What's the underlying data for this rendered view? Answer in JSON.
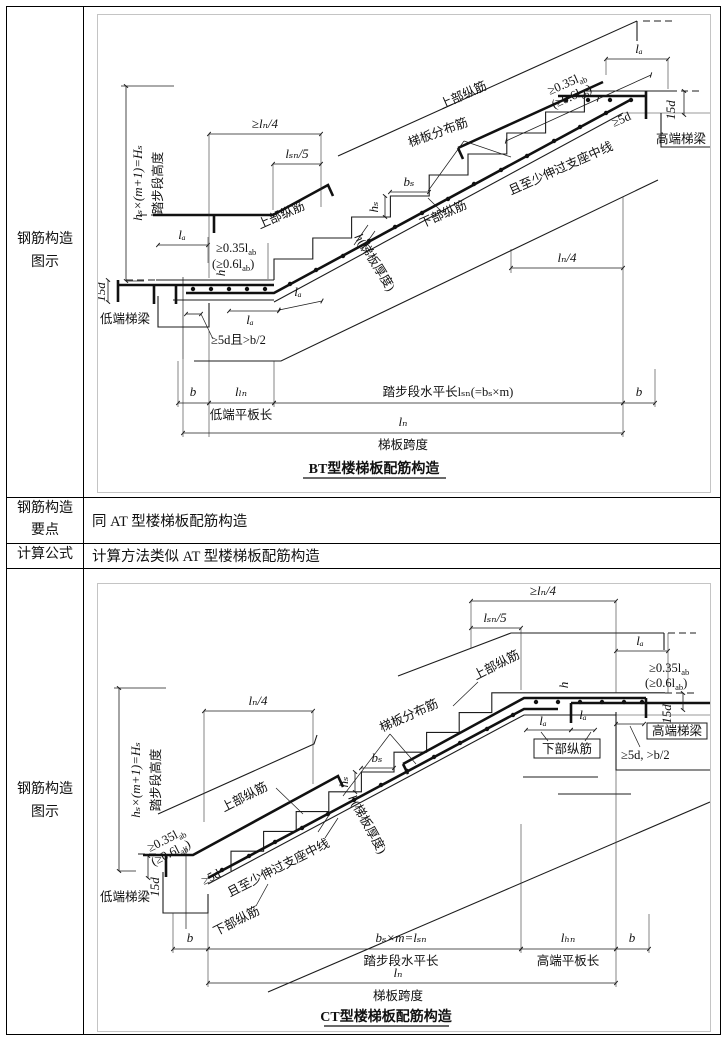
{
  "table": {
    "row_diagram_header": [
      "钢筋构造",
      "图示"
    ],
    "row_points_header": [
      "钢筋构造",
      "要点"
    ],
    "row_points_text": "同 AT 型楼梯板配筋构造",
    "row_formula_header": "计算公式",
    "row_formula_text": "计算方法类似 AT 型楼梯板配筋构造"
  },
  "labels": {
    "upper_bar": "上部纵筋",
    "lower_bar": "下部纵筋",
    "dist_bar": "梯板分布筋",
    "low_beam": "低端梯梁",
    "high_beam": "高端梯梁",
    "anchor_mid": "且至少伸过支座中线",
    "geq5d": "≥5d",
    "geq5d_b2": "≥5d且>b/2",
    "geq5d_b2_comma": "≥5d, >b/2",
    "d15": "15d",
    "h_formula": "hₛ×(m+1)=Hₛ",
    "step_height": "踏步段高度",
    "geq_ln4": "≥lₙ/4",
    "ln4": "lₙ/4",
    "lsn5": "lₛₙ/5",
    "la": "lₐ",
    "ln": "lₙ",
    "lln": "lₗₙ",
    "lhn": "lₕₙ",
    "b": "b",
    "bs": "bₛ",
    "hs": "hₛ",
    "h": "h",
    "slab_thickness": "(梯板厚度)",
    "p035": "≥0.35l",
    "p06": "(≥0.6l",
    "sub_ab": "ab",
    "paren": ")",
    "tread_len_bt": "踏步段水平长lₛₙ(=bₛ×m)",
    "tread_len_ct_formula": "bₛ×m=lₛₙ",
    "tread_len_ct": "踏步段水平长",
    "low_slab_len": "低端平板长",
    "high_slab_len": "高端平板长",
    "span": "梯板跨度",
    "bt_title": "BT型楼梯板配筋构造",
    "ct_title": "CT型楼梯板配筋构造"
  }
}
